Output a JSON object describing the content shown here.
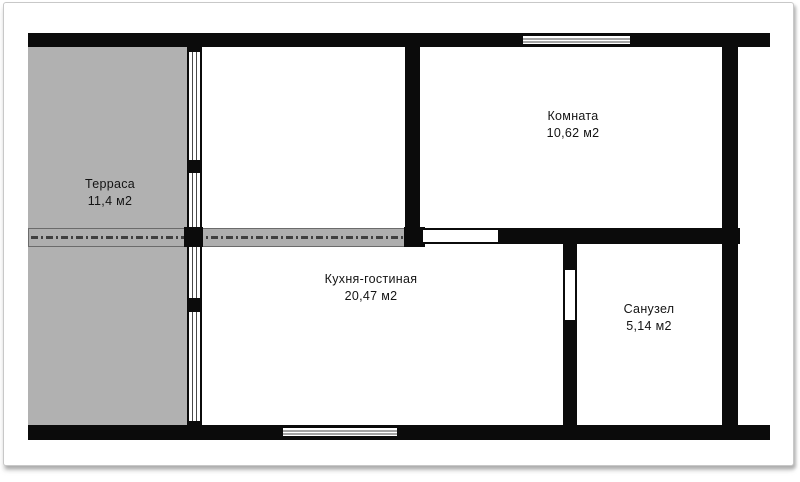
{
  "plan": {
    "type": "floor-plan",
    "rooms": [
      {
        "name": "Терраса",
        "area": "11,4 м2"
      },
      {
        "name": "Комната",
        "area": "10,62 м2"
      },
      {
        "name": "Кухня-гостиная",
        "area": "20,47 м2"
      },
      {
        "name": "Санузел",
        "area": "5,14 м2"
      }
    ]
  },
  "colors": {
    "wall": "#0b0b0b",
    "terrace": "#b1b1b1",
    "band": "#aeaeae",
    "bandline": "#3f3f3f",
    "text": "#141414",
    "paper": "#ffffff",
    "frameborder": "#c8c8c8"
  }
}
